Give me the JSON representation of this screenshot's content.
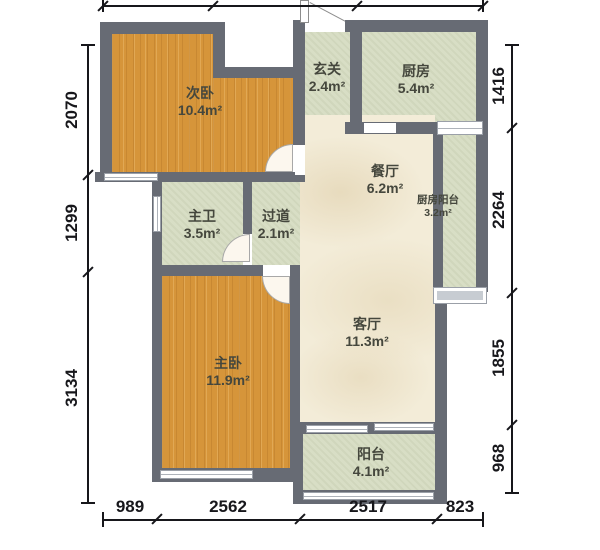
{
  "plan": {
    "title": "apartment-floorplan",
    "rooms": [
      {
        "name": "次卧",
        "area": "10.4m²"
      },
      {
        "name": "玄关",
        "area": "2.4m²"
      },
      {
        "name": "厨房",
        "area": "5.4m²"
      },
      {
        "name": "餐厅",
        "area": "6.2m²"
      },
      {
        "name": "厨房阳台",
        "area": "3.2m²"
      },
      {
        "name": "主卫",
        "area": "3.5m²"
      },
      {
        "name": "过道",
        "area": "2.1m²"
      },
      {
        "name": "客厅",
        "area": "11.3m²"
      },
      {
        "name": "主卧",
        "area": "11.9m²"
      },
      {
        "name": "阳台",
        "area": "4.1m²"
      }
    ],
    "dimensions_mm": {
      "left": [
        "2070",
        "1299",
        "3134"
      ],
      "right": [
        "1416",
        "2264",
        "1855",
        "968"
      ],
      "bottom": [
        "989",
        "2562",
        "2517",
        "823"
      ]
    },
    "colors": {
      "wall": "#676b74",
      "bedroom_floor": "#d6953a",
      "hall_floor": "#f3ecd8",
      "utility_floor": "#d8dec5"
    }
  }
}
